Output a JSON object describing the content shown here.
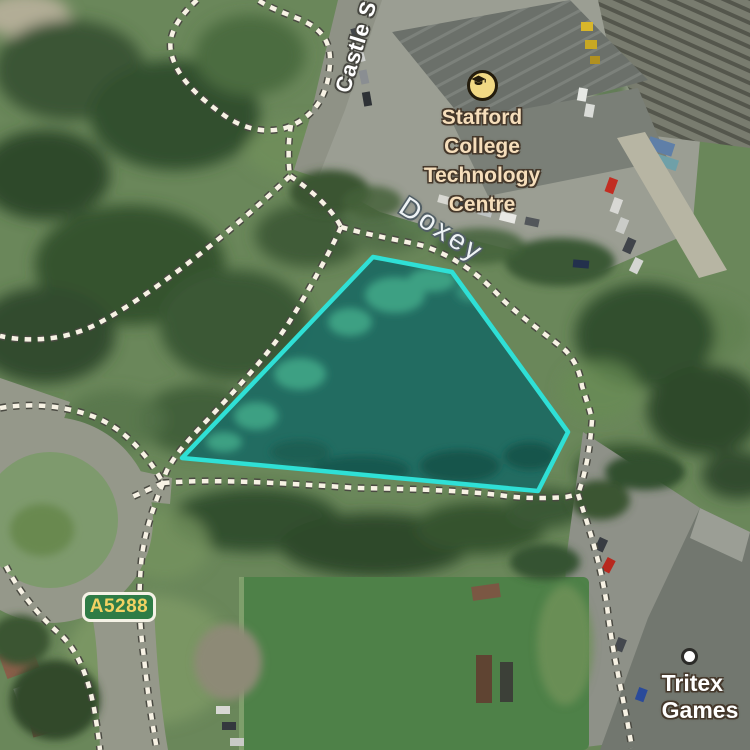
{
  "map": {
    "view_type": "satellite",
    "labels": {
      "street_name": "Castle S",
      "locality_name": "Doxey",
      "college_name_line1": "Stafford College",
      "college_name_line2": "Technology Centre",
      "road_ref": "A5288",
      "business_name": "Tritex Games"
    },
    "icons": {
      "college": "graduation-cap-icon",
      "business": "poi-dot-icon",
      "paths": "dotted-footpath"
    },
    "selection": {
      "description": "highlighted pond parcel",
      "points": "373,257 452,272 568,432 538,491 182,458",
      "stroke": "#2fe0d6",
      "fill": "#1f6b62"
    },
    "colors": {
      "road_badge_bg": "#2f7c46",
      "road_badge_border": "#f5f2e6",
      "road_badge_text": "#f2d263",
      "college_label": "#f6debb",
      "college_icon_bg": "#f2d984",
      "street_label": "#ffffff",
      "locality_label": "#eef3f5",
      "business_label": "#ffffff",
      "footpath_dot": "#f7f2e4",
      "footpath_outline": "#4a4a42"
    }
  }
}
